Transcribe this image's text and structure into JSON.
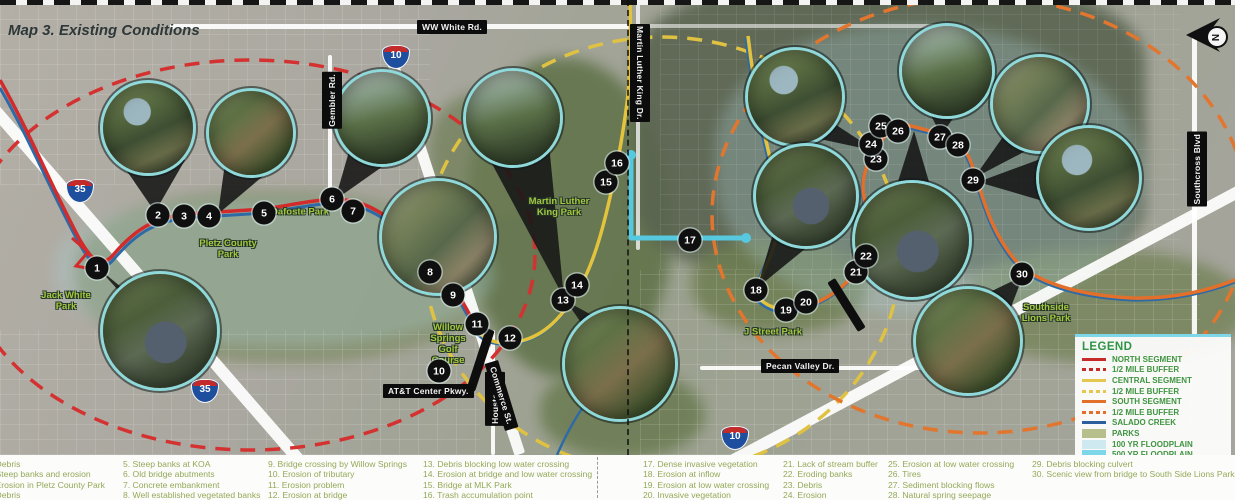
{
  "map": {
    "title": "Map 3. Existing Conditions",
    "compass_label": "N",
    "roads": [
      {
        "id": "ww-white",
        "label": "WW White Rd.",
        "dir": "h"
      },
      {
        "id": "gembler",
        "label": "Gembler Rd.",
        "dir": "up"
      },
      {
        "id": "mlk-dr",
        "label": "Martin Luther King Dr.",
        "dir": "down"
      },
      {
        "id": "houston",
        "label": "Houston St.",
        "dir": "up"
      },
      {
        "id": "commerce",
        "label": "Commerce St.",
        "dir": "h"
      },
      {
        "id": "att-center",
        "label": "AT&T Center Pkwy.",
        "dir": "h"
      },
      {
        "id": "pecan-valley",
        "label": "Pecan Valley Dr.",
        "dir": "h"
      },
      {
        "id": "southcross",
        "label": "Southcross Blvd",
        "dir": "up"
      }
    ],
    "highway_shields": [
      {
        "id": "i35-north",
        "num": "35"
      },
      {
        "id": "i10-west",
        "num": "10"
      },
      {
        "id": "i35-south",
        "num": "35"
      },
      {
        "id": "i10-east",
        "num": "10"
      }
    ],
    "parks": [
      {
        "id": "jack-white",
        "label": "Jack White\nPark"
      },
      {
        "id": "pletz",
        "label": "Pletz County\nPark"
      },
      {
        "id": "dafoste",
        "label": "Dafoste Park"
      },
      {
        "id": "mlk-park",
        "label": "Martin Luther\nKing Park"
      },
      {
        "id": "willow",
        "label": "Willow\nSprings\nGolf\nCourse"
      },
      {
        "id": "j-street",
        "label": "J Street Park"
      },
      {
        "id": "lions",
        "label": "Southside\nLions Park"
      }
    ],
    "markers": [
      {
        "n": "1",
        "x": 97,
        "y": 268
      },
      {
        "n": "2",
        "x": 158,
        "y": 215
      },
      {
        "n": "3",
        "x": 184,
        "y": 216
      },
      {
        "n": "4",
        "x": 209,
        "y": 216
      },
      {
        "n": "5",
        "x": 264,
        "y": 213
      },
      {
        "n": "6",
        "x": 332,
        "y": 199
      },
      {
        "n": "7",
        "x": 353,
        "y": 211
      },
      {
        "n": "8",
        "x": 430,
        "y": 272
      },
      {
        "n": "9",
        "x": 453,
        "y": 295
      },
      {
        "n": "10",
        "x": 439,
        "y": 371
      },
      {
        "n": "11",
        "x": 477,
        "y": 324
      },
      {
        "n": "12",
        "x": 510,
        "y": 338
      },
      {
        "n": "13",
        "x": 563,
        "y": 300
      },
      {
        "n": "14",
        "x": 577,
        "y": 285
      },
      {
        "n": "15",
        "x": 606,
        "y": 182
      },
      {
        "n": "16",
        "x": 617,
        "y": 163
      },
      {
        "n": "17",
        "x": 690,
        "y": 240
      },
      {
        "n": "18",
        "x": 756,
        "y": 290
      },
      {
        "n": "19",
        "x": 786,
        "y": 310
      },
      {
        "n": "20",
        "x": 806,
        "y": 302
      },
      {
        "n": "21",
        "x": 856,
        "y": 272
      },
      {
        "n": "22",
        "x": 866,
        "y": 256
      },
      {
        "n": "23",
        "x": 876,
        "y": 159
      },
      {
        "n": "24",
        "x": 871,
        "y": 144
      },
      {
        "n": "25",
        "x": 881,
        "y": 126
      },
      {
        "n": "26",
        "x": 898,
        "y": 131
      },
      {
        "n": "27",
        "x": 940,
        "y": 137
      },
      {
        "n": "28",
        "x": 958,
        "y": 145
      },
      {
        "n": "29",
        "x": 973,
        "y": 180
      },
      {
        "n": "30",
        "x": 1022,
        "y": 274
      }
    ]
  },
  "legend": {
    "title": "LEGEND",
    "items": [
      {
        "label": "NORTH SEGMENT",
        "swatch": "line",
        "color": "#c62a2a"
      },
      {
        "label": "1/2 MILE BUFFER",
        "swatch": "dash",
        "color": "#c62a2a"
      },
      {
        "label": "CENTRAL SEGMENT",
        "swatch": "line",
        "color": "#e5c74f"
      },
      {
        "label": "1/2 MILE BUFFER",
        "swatch": "dash",
        "color": "#e5c74f"
      },
      {
        "label": "SOUTH SEGMENT",
        "swatch": "line",
        "color": "#e2702a"
      },
      {
        "label": "1/2 MILE BUFFER",
        "swatch": "dash",
        "color": "#e2702a"
      },
      {
        "label": "SALADO CREEK",
        "swatch": "line",
        "color": "#2d5f9e"
      },
      {
        "label": "PARKS",
        "swatch": "fill",
        "color": "#b7bf8d"
      },
      {
        "label": "100 YR FLOODPLAIN",
        "swatch": "fill",
        "color": "#cfe9f1"
      },
      {
        "label": "500 YR FLOODPLAIN",
        "swatch": "fill",
        "color": "#7ed7e9"
      }
    ]
  },
  "notes": {
    "columns": [
      {
        "x": -14,
        "items": [
          "1. Debris",
          "2. Steep banks and erosion",
          "3. Erosion in Pletz County Park",
          "4. Debris"
        ]
      },
      {
        "x": 123,
        "items": [
          "5. Steep banks at KOA",
          "6. Old bridge abutments",
          "7. Concrete embankment",
          "8. Well established vegetated banks"
        ]
      },
      {
        "x": 268,
        "items": [
          "9. Bridge crossing by Willow Springs",
          "10. Erosion of tributary",
          "11. Erosion problem",
          "12. Erosion at bridge"
        ]
      },
      {
        "x": 423,
        "items": [
          "13. Debris blocking low water crossing",
          "14. Erosion at bridge and low water crossing",
          "15. Bridge at MLK Park",
          "16. Trash accumulation point"
        ]
      },
      {
        "x": 643,
        "items": [
          "17. Dense invasive vegetation",
          "18. Erosion at inflow",
          "19. Erosion at low water crossing",
          "20. Invasive vegetation"
        ]
      },
      {
        "x": 783,
        "items": [
          "21. Lack of stream buffer",
          "22. Eroding banks",
          "23. Debris",
          "24. Erosion"
        ]
      },
      {
        "x": 888,
        "items": [
          "25. Erosion at low water crossing",
          "26. Tires",
          "27. Sediment blocking flows",
          "28. Natural spring seepage"
        ]
      },
      {
        "x": 1032,
        "items": [
          "29. Debris blocking culvert",
          "30. Scenic view from bridge to South Side Lions Park"
        ]
      }
    ]
  }
}
